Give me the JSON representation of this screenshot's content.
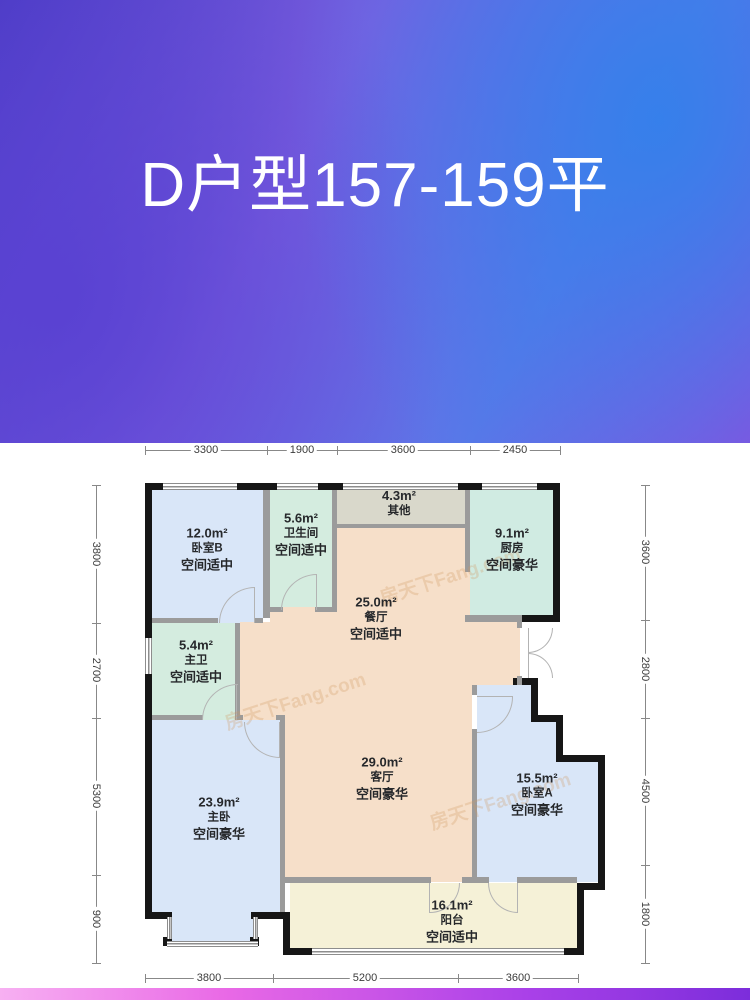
{
  "title": "D户型157-159平",
  "watermark": "房天下Fang.com",
  "dimensions": {
    "top": [
      "3300",
      "1900",
      "3600",
      "2450"
    ],
    "left": [
      "3800",
      "2700",
      "5300",
      "900"
    ],
    "right": [
      "3600",
      "2800",
      "4500",
      "1800"
    ],
    "bottom": [
      "3800",
      "5200",
      "3600"
    ]
  },
  "rooms": [
    {
      "area": "12.0m²",
      "name": "卧室B",
      "grade": "空间适中"
    },
    {
      "area": "5.6m²",
      "name": "卫生间",
      "grade": "空间适中"
    },
    {
      "area": "4.3m²",
      "name": "其他",
      "grade": ""
    },
    {
      "area": "9.1m²",
      "name": "厨房",
      "grade": "空间豪华"
    },
    {
      "area": "25.0m²",
      "name": "餐厅",
      "grade": "空间适中"
    },
    {
      "area": "5.4m²",
      "name": "主卫",
      "grade": "空间适中"
    },
    {
      "area": "29.0m²",
      "name": "客厅",
      "grade": "空间豪华"
    },
    {
      "area": "23.9m²",
      "name": "主卧",
      "grade": "空间豪华"
    },
    {
      "area": "15.5m²",
      "name": "卧室A",
      "grade": "空间豪华"
    },
    {
      "area": "16.1m²",
      "name": "阳台",
      "grade": "空间适中"
    }
  ],
  "colors": {
    "bedroom_fill": "#d9e6f8",
    "bathroom_fill": "#d4ecdf",
    "kitchen_fill": "#d0ebe2",
    "other_fill": "#d9d8cb",
    "hall_fill": "#f6dfc9",
    "balcony_fill": "#f5f1d7",
    "exterior_wall": "#161616",
    "interior_wall": "#9b9b9b",
    "title_color": "#ffffff"
  }
}
